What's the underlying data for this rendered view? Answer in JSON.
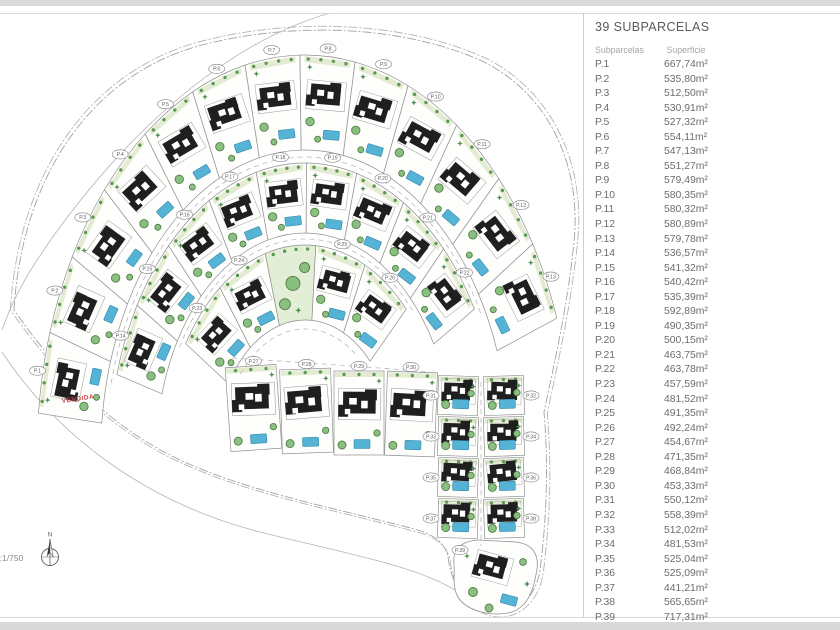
{
  "panel": {
    "title": "39 SUBPARCELAS",
    "col_headers": [
      "Subparcelas",
      "Superficie"
    ],
    "rows": [
      {
        "label": "P.1",
        "value": "667,74m²"
      },
      {
        "label": "P.2",
        "value": "535,80m²"
      },
      {
        "label": "P.3",
        "value": "512,50m²"
      },
      {
        "label": "P.4",
        "value": "530,91m²"
      },
      {
        "label": "P.5",
        "value": "527,32m²"
      },
      {
        "label": "P.6",
        "value": "554,11m²"
      },
      {
        "label": "P.7",
        "value": "547,13m²"
      },
      {
        "label": "P.8",
        "value": "551,27m²"
      },
      {
        "label": "P.9",
        "value": "579,49m²"
      },
      {
        "label": "P.10",
        "value": "580,35m²"
      },
      {
        "label": "P.11",
        "value": "580,32m²"
      },
      {
        "label": "P.12",
        "value": "580,89m²"
      },
      {
        "label": "P.13",
        "value": "579,78m²"
      },
      {
        "label": "P.14",
        "value": "536,57m²"
      },
      {
        "label": "P.15",
        "value": "541,32m²"
      },
      {
        "label": "P.16",
        "value": "540,42m²"
      },
      {
        "label": "P.17",
        "value": "535,39m²"
      },
      {
        "label": "P.18",
        "value": "592,89m²"
      },
      {
        "label": "P.19",
        "value": "490,35m²"
      },
      {
        "label": "P.20",
        "value": "500,15m²"
      },
      {
        "label": "P.21",
        "value": "463,75m²"
      },
      {
        "label": "P.22",
        "value": "463,78m²"
      },
      {
        "label": "P.23",
        "value": "457,59m²"
      },
      {
        "label": "P.24",
        "value": "481,52m²"
      },
      {
        "label": "P.25",
        "value": "491,35m²"
      },
      {
        "label": "P.26",
        "value": "492,24m²"
      },
      {
        "label": "P.27",
        "value": "454,67m²"
      },
      {
        "label": "P.28",
        "value": "471,35m²"
      },
      {
        "label": "P.29",
        "value": "468,84m²"
      },
      {
        "label": "P.30",
        "value": "453,33m²"
      },
      {
        "label": "P.31",
        "value": "550,12m²"
      },
      {
        "label": "P.32",
        "value": "558,39m²"
      },
      {
        "label": "P.33",
        "value": "512,02m²"
      },
      {
        "label": "P.34",
        "value": "481,53m²"
      },
      {
        "label": "P.35",
        "value": "525,04m²"
      },
      {
        "label": "P.36",
        "value": "525,09m²"
      },
      {
        "label": "P.37",
        "value": "441,21m²"
      },
      {
        "label": "P.38",
        "value": "565,65m²"
      },
      {
        "label": "P.39",
        "value": "717,31m²"
      }
    ]
  },
  "plan": {
    "scale_text": "e:1/750",
    "compass_label": "N",
    "sold_label": "VENDIDA",
    "parcel_labels": [
      "P.1",
      "P.2",
      "P.3",
      "P.4",
      "P.5",
      "P.6",
      "P.7",
      "P.8",
      "P.9",
      "P.10",
      "P.11",
      "P.12",
      "P.13",
      "P.14",
      "P.15",
      "P.16",
      "P.17",
      "P.18",
      "P.19",
      "P.20",
      "P.21",
      "P.22",
      "P.23",
      "P.24",
      "P.25",
      "P.26",
      "P.27",
      "P.28",
      "P.29",
      "P.30",
      "P.31",
      "P.32",
      "P.33",
      "P.34",
      "P.35",
      "P.36",
      "P.37",
      "P.38",
      "P.39"
    ],
    "colors": {
      "boundary": "#a3a3a3",
      "road_line": "#b5b5b5",
      "parcel_stroke": "#8f8f8f",
      "parcel_fill": "#fefefd",
      "building": "#1f1f1f",
      "building_outline": "#9a9a9a",
      "pool_fill": "#55b4d6",
      "pool_stroke": "#2f86a8",
      "tree_fill": "#8abf82",
      "tree_stroke": "#527f46",
      "tree_dot": "#5c9a52",
      "strip": "#e3ecd3",
      "park_fill": "#e2eed6",
      "star": "#4d8f4d",
      "dash": "#b9b9b9",
      "marker_fill": "#ffffff",
      "marker_stroke": "#909090",
      "marker_text": "#5f5f5f",
      "sold": "#c94b4b",
      "annotation": "#8a8a8a",
      "compass": "#5f5f5f"
    },
    "geometry": {
      "center": {
        "x": 305,
        "y": 455
      },
      "kx": 0.67,
      "rings": [
        {
          "r1": 305,
          "r2": 400,
          "a0": 186,
          "a1": 340,
          "count": 13,
          "park_index": -1
        },
        {
          "r1": 222,
          "r2": 292,
          "a0": 196,
          "a1": 330,
          "count": 9,
          "park_index": -1
        },
        {
          "r1": 135,
          "r2": 210,
          "a0": 212,
          "a1": 316,
          "count": 5,
          "park_index": 2
        }
      ],
      "row_parcels": [
        {
          "x": 228,
          "y": 366,
          "w": 51,
          "h": 84,
          "rot": -4
        },
        {
          "x": 281,
          "y": 369,
          "w": 51,
          "h": 84,
          "rot": -2
        },
        {
          "x": 334,
          "y": 371,
          "w": 50,
          "h": 84,
          "rot": 0
        },
        {
          "x": 386,
          "y": 372,
          "w": 50,
          "h": 84,
          "rot": 2
        }
      ],
      "tail": {
        "cols": [
          438,
          484
        ],
        "w": 40,
        "rows": [
          376,
          417,
          458,
          499
        ],
        "h": 39
      },
      "tip": {
        "d": "M454,564 C452,549 462,541 478,540 L516,542 C533,544 539,555 537,569 C534,588 529,606 512,612 C494,617 467,612 458,597 C452,587 455,575 454,564 Z",
        "cx": 495,
        "cy": 576,
        "rot": 15
      },
      "dash_arcs": [
        {
          "r": 298,
          "a0": 194,
          "a1": 332
        },
        {
          "r": 216,
          "a0": 210,
          "a1": 318
        },
        {
          "r": 126,
          "a0": 220,
          "a1": 308
        }
      ],
      "dash_lines": [
        "M232,358 Q330,364 430,372",
        "M481,382 L481,546"
      ],
      "boundaries": {
        "site": "M14,310 C22,176 92,72 206,44 C294,22 402,25 482,61 C546,92 582,162 574,242 C568,302 556,356 544,412 C549,470 546,524 540,570 C534,608 502,622 478,608 C460,597 450,578 448,556 C444,542 434,535 418,530 C328,506 238,490 168,454 C110,424 60,376 14,310 Z",
        "nw_road": "M330,13 C236,40 138,118 52,238 C34,264 16,290 2,330",
        "south_road": "M2,352 C64,446 158,506 260,532 C348,554 418,566 458,592"
      },
      "sold_pos": {
        "x": 62,
        "y": 403,
        "rot": -8
      },
      "scale_pos": {
        "x": -5,
        "y": 561
      },
      "compass_pos": {
        "x": 50,
        "y": 557
      }
    }
  }
}
